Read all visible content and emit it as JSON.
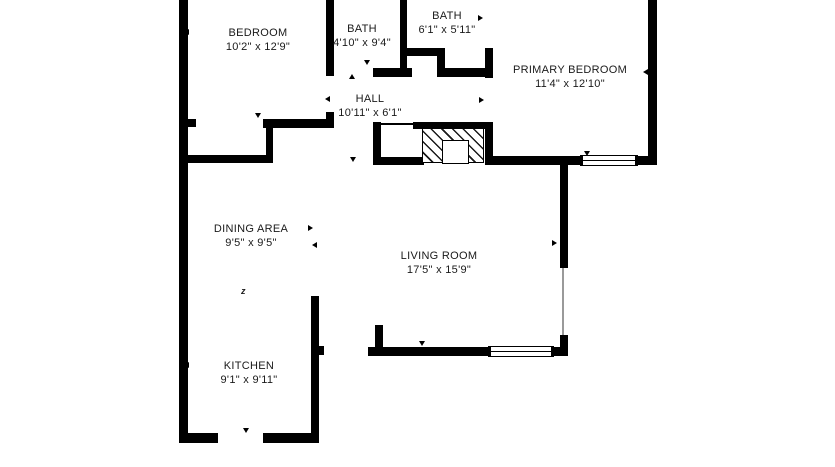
{
  "plan_title": "floor-plan",
  "colors": {
    "wall": "#000000",
    "background": "#ffffff",
    "text": "#1a1a1a"
  },
  "rooms": {
    "bedroom": {
      "name": "BEDROOM",
      "dims": "10'2\" x 12'9\""
    },
    "bath1": {
      "name": "BATH",
      "dims": "4'10\" x 9'4\""
    },
    "bath2": {
      "name": "BATH",
      "dims": "6'1\" x 5'11\""
    },
    "primary": {
      "name": "PRIMARY BEDROOM",
      "dims": "11'4\" x 12'10\""
    },
    "hall": {
      "name": "HALL",
      "dims": "10'11\" x 6'1\""
    },
    "dining": {
      "name": "DINING AREA",
      "dims": "9'5\" x 9'5\""
    },
    "living": {
      "name": "LIVING ROOM",
      "dims": "17'5\" x 15'9\""
    },
    "kitchen": {
      "name": "KITCHEN",
      "dims": "9'1\" x 9'11\""
    }
  },
  "markers": {
    "dining_zigzag": "z"
  }
}
